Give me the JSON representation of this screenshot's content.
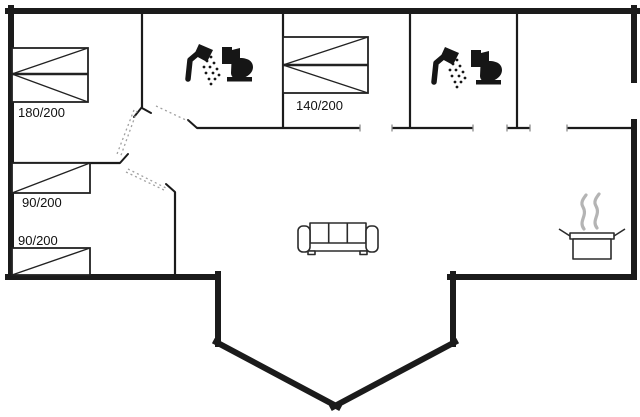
{
  "plan": {
    "kind": "holiday-house floor plan",
    "rooms": {
      "bedroom_top_left": {
        "bed_size": "180/200"
      },
      "bedroom_top_middle": {
        "bed_size": "140/200"
      },
      "bedroom_bottom_left": {
        "bed_size_upper": "90/200",
        "bed_size_lower": "90/200"
      }
    }
  },
  "icons": {
    "shower": "shower-icon",
    "toilet": "toilet-icon",
    "sofa": "sofa-icon",
    "cooking_pot": "cooking-pot-icon",
    "steam": "steam-icon"
  },
  "colors": {
    "wall": "#1b1b1b",
    "furniture_line": "#2b2b2b",
    "steam": "#b4b4b4",
    "background": "#ffffff"
  }
}
